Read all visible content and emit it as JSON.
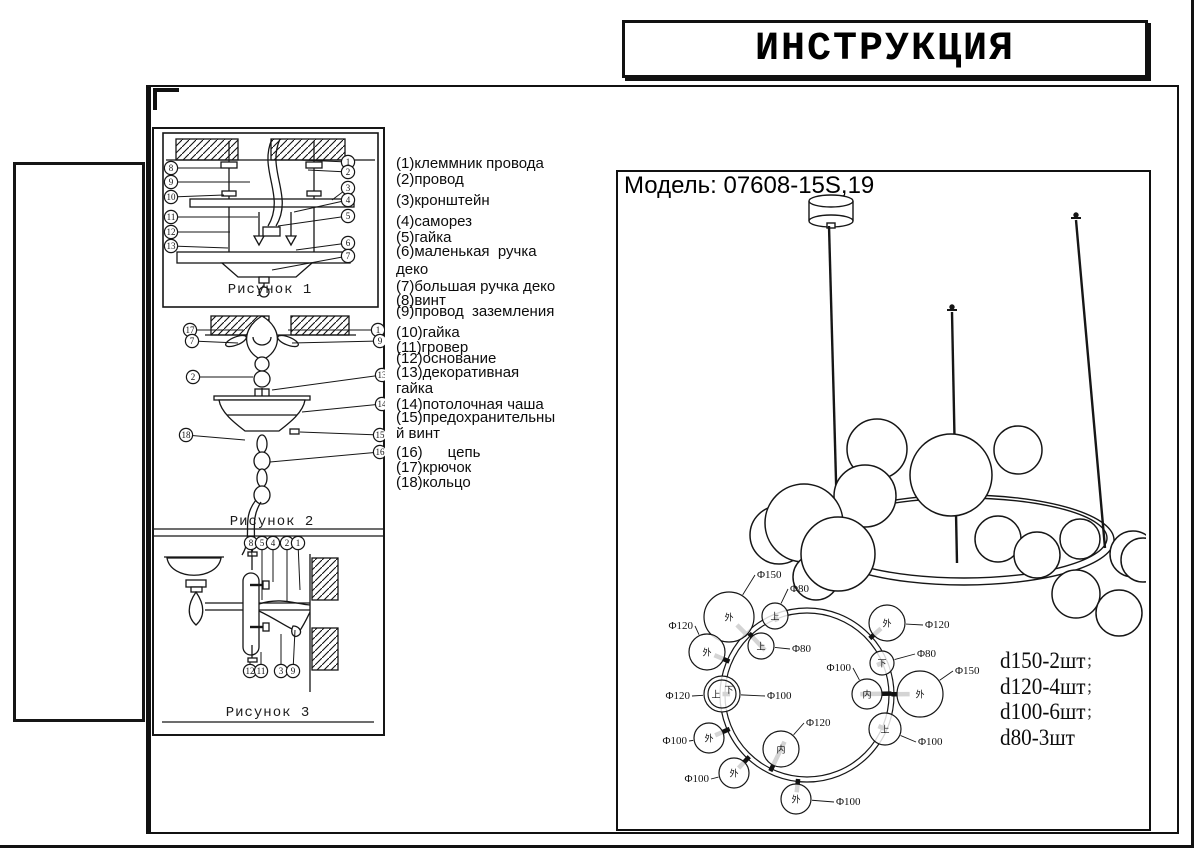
{
  "document": {
    "title": "ИНСТРУКЦИЯ",
    "model_label": "Модель: 07608-15S,19"
  },
  "parts_list": {
    "lines": [
      {
        "text": "(1)клеммник провода",
        "y": 156
      },
      {
        "text": "(2)провод",
        "y": 172
      },
      {
        "text": "(3)кронштейн",
        "y": 193
      },
      {
        "text": "(4)саморез",
        "y": 214
      },
      {
        "text": "(5)гайка",
        "y": 230
      },
      {
        "text": "(6)маленькая  ручка",
        "y": 244
      },
      {
        "text": "деко",
        "y": 262
      },
      {
        "text": "(7)большая ручка деко",
        "y": 279
      },
      {
        "text": "(8)винт",
        "y": 293
      },
      {
        "text": "(9)провод  заземления",
        "y": 304
      },
      {
        "text": "(10)гайка",
        "y": 325
      },
      {
        "text": "(11)гровер",
        "y": 340
      },
      {
        "text": "(12)основание",
        "y": 351
      },
      {
        "text": "(13)декоративная",
        "y": 365
      },
      {
        "text": "гайка",
        "y": 381
      },
      {
        "text": "(14)потолочная чаша",
        "y": 397
      },
      {
        "text": "(15)предохранительны",
        "y": 410
      },
      {
        "text": "й винт",
        "y": 426
      },
      {
        "text": "(16)      цепь",
        "y": 445
      },
      {
        "text": "(17)крючок",
        "y": 460
      },
      {
        "text": "(18)кольцо",
        "y": 475
      }
    ]
  },
  "figures": [
    {
      "caption": "Рисунок 1",
      "cx": 270,
      "cy": 293,
      "callouts": [
        {
          "n": "8",
          "x": 171,
          "y": 168,
          "tx": 224,
          "ty": 168
        },
        {
          "n": "9",
          "x": 171,
          "y": 182,
          "tx": 250,
          "ty": 182
        },
        {
          "n": "10",
          "x": 171,
          "y": 197,
          "tx": 224,
          "ty": 195
        },
        {
          "n": "11",
          "x": 171,
          "y": 217,
          "tx": 258,
          "ty": 217
        },
        {
          "n": "12",
          "x": 171,
          "y": 232,
          "tx": 230,
          "ty": 232
        },
        {
          "n": "13",
          "x": 171,
          "y": 246,
          "tx": 228,
          "ty": 248
        },
        {
          "n": "1",
          "x": 348,
          "y": 162,
          "tx": 300,
          "ty": 160
        },
        {
          "n": "2",
          "x": 348,
          "y": 172,
          "tx": 308,
          "ty": 170
        },
        {
          "n": "3",
          "x": 348,
          "y": 188,
          "tx": 332,
          "ty": 200
        },
        {
          "n": "4",
          "x": 348,
          "y": 200,
          "tx": 294,
          "ty": 212
        },
        {
          "n": "5",
          "x": 348,
          "y": 216,
          "tx": 278,
          "ty": 226
        },
        {
          "n": "6",
          "x": 348,
          "y": 243,
          "tx": 296,
          "ty": 250
        },
        {
          "n": "7",
          "x": 348,
          "y": 256,
          "tx": 272,
          "ty": 270
        }
      ]
    },
    {
      "caption": "Рисунок 2",
      "cx": 272,
      "cy": 525,
      "callouts": [
        {
          "n": "17",
          "x": 190,
          "y": 330,
          "tx": 243,
          "ty": 330
        },
        {
          "n": "7",
          "x": 192,
          "y": 341,
          "tx": 238,
          "ty": 343
        },
        {
          "n": "2",
          "x": 193,
          "y": 377,
          "tx": 253,
          "ty": 377
        },
        {
          "n": "18",
          "x": 186,
          "y": 435,
          "tx": 245,
          "ty": 440
        },
        {
          "n": "1",
          "x": 378,
          "y": 330,
          "tx": 288,
          "ty": 330
        },
        {
          "n": "9",
          "x": 380,
          "y": 341,
          "tx": 292,
          "ty": 343
        },
        {
          "n": "13",
          "x": 382,
          "y": 375,
          "tx": 272,
          "ty": 390
        },
        {
          "n": "14",
          "x": 382,
          "y": 404,
          "tx": 302,
          "ty": 412
        },
        {
          "n": "15",
          "x": 380,
          "y": 435,
          "tx": 300,
          "ty": 432
        },
        {
          "n": "16",
          "x": 380,
          "y": 452,
          "tx": 270,
          "ty": 462
        }
      ]
    },
    {
      "caption": "Рисунок  3",
      "cx": 268,
      "cy": 716,
      "callouts": [
        {
          "n": "8",
          "x": 251,
          "y": 543,
          "tx": 252,
          "ty": 556
        },
        {
          "n": "5",
          "x": 262,
          "y": 543,
          "tx": 262,
          "ty": 600
        },
        {
          "n": "4",
          "x": 273,
          "y": 543,
          "tx": 273,
          "ty": 582
        },
        {
          "n": "2",
          "x": 287,
          "y": 543,
          "tx": 287,
          "ty": 601
        },
        {
          "n": "1",
          "x": 298,
          "y": 543,
          "tx": 300,
          "ty": 590
        },
        {
          "n": "12",
          "x": 250,
          "y": 671,
          "tx": 250,
          "ty": 662
        },
        {
          "n": "11",
          "x": 261,
          "y": 671,
          "tx": 261,
          "ty": 652
        },
        {
          "n": "3",
          "x": 281,
          "y": 671,
          "tx": 281,
          "ty": 634
        },
        {
          "n": "9",
          "x": 293,
          "y": 671,
          "tx": 295,
          "ty": 630
        }
      ]
    }
  ],
  "quantities": {
    "x": 1000,
    "mark_x": 1087,
    "lines": [
      {
        "text": "d150-2шт",
        "mark": ";",
        "y": 648
      },
      {
        "text": "d120-4шт",
        "mark": ";",
        "y": 674
      },
      {
        "text": "d100-6шт",
        "mark": ";",
        "y": 699
      },
      {
        "text": "d80-3шт",
        "mark": "",
        "y": 725
      }
    ]
  },
  "top_view": {
    "ring": {
      "cx": 808,
      "cy": 695,
      "r_outer": 87,
      "r_inner": 82
    },
    "globes": [
      {
        "cx": 730,
        "cy": 617,
        "r": 25,
        "char": "外",
        "label": "Φ150",
        "lx": 758,
        "ly": 578,
        "anchor": "start"
      },
      {
        "cx": 776,
        "cy": 616,
        "r": 13,
        "char": "上",
        "label": "Φ80",
        "lx": 791,
        "ly": 592,
        "anchor": "start"
      },
      {
        "cx": 708,
        "cy": 652,
        "r": 18,
        "char": "外",
        "label": "Φ120",
        "lx": 694,
        "ly": 629,
        "anchor": "end"
      },
      {
        "cx": 762,
        "cy": 646,
        "r": 13,
        "char": "上",
        "label": "Φ80",
        "lx": 793,
        "ly": 652,
        "anchor": "start"
      },
      {
        "cx": 888,
        "cy": 623,
        "r": 18,
        "char": "外",
        "label": "Φ120",
        "lx": 926,
        "ly": 628,
        "anchor": "start"
      },
      {
        "cx": 883,
        "cy": 663,
        "r": 12,
        "char": "下",
        "label": "Φ80",
        "lx": 918,
        "ly": 657,
        "anchor": "start"
      },
      {
        "cx": 868,
        "cy": 694,
        "r": 15,
        "char": "内",
        "label": "Φ100",
        "lx": 852,
        "ly": 671,
        "anchor": "end"
      },
      {
        "cx": 921,
        "cy": 694,
        "r": 23,
        "char": "外",
        "label": "Φ150",
        "lx": 956,
        "ly": 674,
        "anchor": "start"
      },
      {
        "cx": 723,
        "cy": 694,
        "r": 18,
        "char": "上",
        "label": "Φ120",
        "lx": 691,
        "ly": 699,
        "anchor": "end",
        "inner_r": 14,
        "char2": "下",
        "label2": "Φ100",
        "lx2": 768,
        "ly2": 699,
        "anchor2": "start"
      },
      {
        "cx": 886,
        "cy": 729,
        "r": 16,
        "char": "上",
        "label": "Φ100",
        "lx": 919,
        "ly": 745,
        "anchor": "start"
      },
      {
        "cx": 710,
        "cy": 738,
        "r": 15,
        "char": "外",
        "label": "Φ100",
        "lx": 688,
        "ly": 744,
        "anchor": "end"
      },
      {
        "cx": 782,
        "cy": 749,
        "r": 18,
        "char": "内",
        "label": "Φ120",
        "lx": 807,
        "ly": 726,
        "anchor": "start"
      },
      {
        "cx": 735,
        "cy": 773,
        "r": 15,
        "char": "外",
        "label": "Φ100",
        "lx": 710,
        "ly": 782,
        "anchor": "end"
      },
      {
        "cx": 797,
        "cy": 799,
        "r": 15,
        "char": "外",
        "label": "Φ100",
        "lx": 837,
        "ly": 805,
        "anchor": "start"
      }
    ]
  },
  "perspective": {
    "canopy": {
      "cx": 832,
      "top": 201,
      "bottom": 221,
      "rx": 22,
      "ry": 6
    },
    "rods": [
      {
        "x1": 830,
        "y1": 226,
        "x2": 839,
        "y2": 553,
        "cap": false
      },
      {
        "x1": 953,
        "y1": 312,
        "x2": 958,
        "y2": 563,
        "cap": true
      },
      {
        "x1": 1077,
        "y1": 220,
        "x2": 1106,
        "y2": 548,
        "cap": true
      }
    ],
    "ring": {
      "cx": 965,
      "cy": 540,
      "rx": 150,
      "ry": 45,
      "rx2": 143,
      "ry2": 40
    },
    "spheres": [
      {
        "cx": 878,
        "cy": 449,
        "r": 30
      },
      {
        "cx": 1019,
        "cy": 450,
        "r": 24
      },
      {
        "cx": 866,
        "cy": 496,
        "r": 31
      },
      {
        "cx": 952,
        "cy": 475,
        "r": 41
      },
      {
        "cx": 999,
        "cy": 539,
        "r": 23
      },
      {
        "cx": 1038,
        "cy": 555,
        "r": 23
      },
      {
        "cx": 1081,
        "cy": 539,
        "r": 20
      },
      {
        "cx": 1134,
        "cy": 554,
        "r": 23
      },
      {
        "cx": 1144,
        "cy": 560,
        "r": 22
      },
      {
        "cx": 1077,
        "cy": 594,
        "r": 24
      },
      {
        "cx": 1120,
        "cy": 613,
        "r": 23
      },
      {
        "cx": 780,
        "cy": 535,
        "r": 29
      },
      {
        "cx": 805,
        "cy": 523,
        "r": 39
      },
      {
        "cx": 817,
        "cy": 577,
        "r": 23
      },
      {
        "cx": 839,
        "cy": 554,
        "r": 37
      }
    ]
  }
}
